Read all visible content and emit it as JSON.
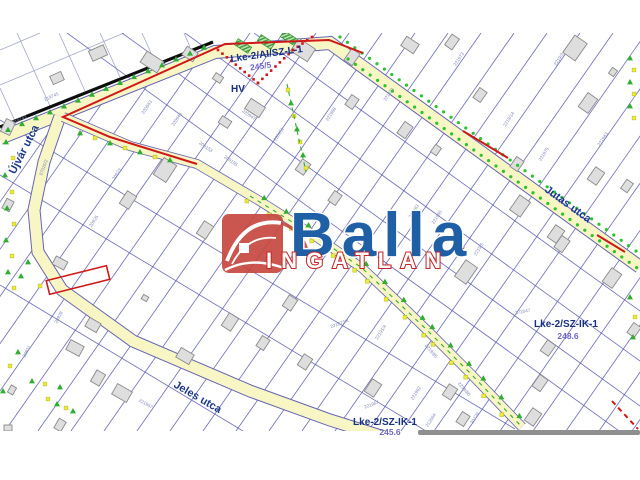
{
  "map": {
    "street_labels": [
      {
        "id": "ujvar",
        "text": "Újvár utca",
        "x": 27,
        "y": 151,
        "rot": -63
      },
      {
        "id": "jutas",
        "text": "Jutas utca",
        "x": 566,
        "y": 207,
        "rot": 36
      },
      {
        "id": "jeles",
        "text": "Jeles utca",
        "x": 196,
        "y": 400,
        "rot": 30
      }
    ],
    "zone_labels": [
      {
        "id": "z1",
        "code": "Lke-2/AI/SZ-L-1",
        "value": "245/5",
        "x": 267,
        "y": 57,
        "vx": 261,
        "vy": 69,
        "rot": -8
      },
      {
        "id": "hv",
        "code": "HV",
        "value": "",
        "x": 238,
        "y": 92,
        "vx": 0,
        "vy": 0,
        "rot": 0
      },
      {
        "id": "z2",
        "code": "Lke-2/SZ-IK-1",
        "value": "248.6",
        "x": 566,
        "y": 327,
        "vx": 568,
        "vy": 339,
        "rot": 0
      },
      {
        "id": "z3",
        "code": "Lke-2/SZ-IK-1",
        "value": "245.6",
        "x": 385,
        "y": 425,
        "vx": 390,
        "vy": 435,
        "rot": 0
      }
    ],
    "parcel_numbers": [
      {
        "t": "219743",
        "x": 20,
        "y": 121,
        "r": -24
      },
      {
        "t": "219745",
        "x": 52,
        "y": 98,
        "r": -24
      },
      {
        "t": "07026/2",
        "x": 45,
        "y": 168,
        "r": -70
      },
      {
        "t": "220943",
        "x": 148,
        "y": 108,
        "r": -57
      },
      {
        "t": "220945",
        "x": 178,
        "y": 120,
        "r": -57
      },
      {
        "t": "220947",
        "x": 248,
        "y": 116,
        "r": 35
      },
      {
        "t": "209153",
        "x": 205,
        "y": 148,
        "r": 35
      },
      {
        "t": "209155",
        "x": 230,
        "y": 162,
        "r": 35
      },
      {
        "t": "20923",
        "x": 118,
        "y": 175,
        "r": -57
      },
      {
        "t": "20925",
        "x": 95,
        "y": 222,
        "r": -57
      },
      {
        "t": "220951",
        "x": 280,
        "y": 135,
        "r": -57
      },
      {
        "t": "221968",
        "x": 332,
        "y": 115,
        "r": -57
      },
      {
        "t": "221971",
        "x": 390,
        "y": 95,
        "r": -57
      },
      {
        "t": "221973",
        "x": 460,
        "y": 60,
        "r": -57
      },
      {
        "t": "2219/3",
        "x": 560,
        "y": 60,
        "r": -57
      },
      {
        "t": "221943",
        "x": 604,
        "y": 140,
        "r": -57
      },
      {
        "t": "2219/14",
        "x": 510,
        "y": 120,
        "r": -57
      },
      {
        "t": "221975",
        "x": 545,
        "y": 155,
        "r": -57
      },
      {
        "t": "221963",
        "x": 415,
        "y": 212,
        "r": -57
      },
      {
        "t": "221965",
        "x": 438,
        "y": 218,
        "r": -57
      },
      {
        "t": "2219/5",
        "x": 480,
        "y": 250,
        "r": -57
      },
      {
        "t": "372047",
        "x": 523,
        "y": 313,
        "r": -10
      },
      {
        "t": "22191/4",
        "x": 382,
        "y": 333,
        "r": -57
      },
      {
        "t": "221973/4",
        "x": 340,
        "y": 325,
        "r": -20
      },
      {
        "t": "2219/85",
        "x": 430,
        "y": 352,
        "r": 50
      },
      {
        "t": "2219/80",
        "x": 463,
        "y": 390,
        "r": 50
      },
      {
        "t": "221967",
        "x": 372,
        "y": 406,
        "r": -20
      },
      {
        "t": "221962",
        "x": 417,
        "y": 394,
        "r": -57
      },
      {
        "t": "212064",
        "x": 432,
        "y": 421,
        "r": -57
      },
      {
        "t": "20729",
        "x": 476,
        "y": 419,
        "r": -57
      },
      {
        "t": "221957",
        "x": 145,
        "y": 405,
        "r": 30
      },
      {
        "t": "20928",
        "x": 60,
        "y": 318,
        "r": -62
      },
      {
        "t": "20931",
        "x": 28,
        "y": 352,
        "r": -62
      }
    ]
  },
  "logo": {
    "brand": "Balla",
    "subtitle": "INGATLAN",
    "trademark": "´",
    "icon": "house-roof-icon"
  },
  "colors": {
    "logo_red": "#c64840",
    "logo_blue": "#1f5fa6",
    "zone_navy": "#16317f",
    "zone_number_violet": "#6e66c8",
    "boundary_red": "#d01818",
    "road_yellow": "#f8f6c4",
    "parcel_line_blue": "#5a5ab2",
    "tree_green": "#2fae2f",
    "tree_yellow": "#ecec3e",
    "building_gray": "#dedede"
  }
}
